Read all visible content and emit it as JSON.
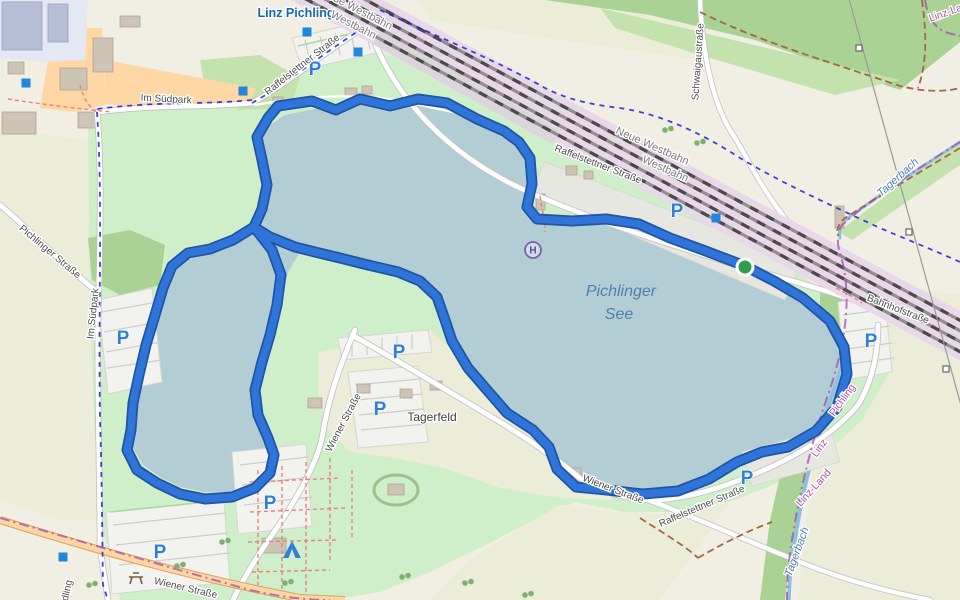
{
  "colors": {
    "land": "#f1efe3",
    "field": "#ecedd8",
    "park": "#cfeeca",
    "wood": "#a9d294",
    "wood_light": "#c3e2ae",
    "water": "#b3cdd5",
    "stream": "#8fc0e0",
    "railway_band": "#e9d8e9",
    "track": "#4a4a4a",
    "track_base": "#8f8f8f",
    "road": "#ffffff",
    "road_casing": "#c2c2c2",
    "primary": "#fcd6a4",
    "primary_casing": "#d9a659",
    "route": "#2f74d9",
    "route_casing": "#1f55a3",
    "cycle": "#2121d6",
    "boundary": "#a04fae",
    "path_red": "#e88378",
    "track_brown": "#a5673f",
    "parking": "#2f7fd6",
    "node": "#2386dd",
    "start": "#2e9e4c",
    "building": "#cdc4b6",
    "building_line": "#b2a391",
    "paved": "#e7e7e1",
    "industrial": "#b7bfd6",
    "retail": "#fed7a5",
    "label_street": "#4d4d4d",
    "label_railway": "#7d7d7d",
    "label_station": "#1467b5",
    "label_place": "#41413b",
    "label_water": "#4d7fae",
    "label_boundary": "#b14fb1"
  },
  "map": {
    "lake_name": "Pichlinger See",
    "station_name": "Linz Pichling",
    "labels": [
      {
        "t": "Linz Pichling",
        "x": 296,
        "y": 17,
        "r": 0,
        "c": "station"
      },
      {
        "t": "Neue Westbahn",
        "x": 355,
        "y": 12,
        "r": 27,
        "c": "railway"
      },
      {
        "t": "Westbahn",
        "x": 352,
        "y": 28,
        "r": 27,
        "c": "railway"
      },
      {
        "t": "Neue Westbahn",
        "x": 651,
        "y": 149,
        "r": 24,
        "c": "railway"
      },
      {
        "t": "Westbahn",
        "x": 664,
        "y": 172,
        "r": 24,
        "c": "railway"
      },
      {
        "t": "Raffelstettner Straße",
        "x": 304,
        "y": 67,
        "r": -38,
        "c": "street"
      },
      {
        "t": "Raffelstettner Straße",
        "x": 597,
        "y": 167,
        "r": 21,
        "c": "street"
      },
      {
        "t": "Raffelstettner Straße",
        "x": 703,
        "y": 509,
        "r": -23,
        "c": "street"
      },
      {
        "t": "Im Südpark",
        "x": 166,
        "y": 102,
        "r": 3,
        "c": "street"
      },
      {
        "t": "Im Südpark",
        "x": 96,
        "y": 314,
        "r": -84,
        "c": "street"
      },
      {
        "t": "Pichlinger Straße",
        "x": 48,
        "y": 254,
        "r": 40,
        "c": "street"
      },
      {
        "t": "Wiener Straße",
        "x": 346,
        "y": 424,
        "r": -62,
        "c": "street"
      },
      {
        "t": "Wiener Straße",
        "x": 612,
        "y": 492,
        "r": 21,
        "c": "street"
      },
      {
        "t": "Wiener Straße",
        "x": 185,
        "y": 591,
        "r": 13,
        "c": "street"
      },
      {
        "t": "Bahnhofstraße",
        "x": 897,
        "y": 312,
        "r": 21,
        "c": "street"
      },
      {
        "t": "Schwaigaustraße",
        "x": 701,
        "y": 62,
        "r": -86,
        "c": "street"
      },
      {
        "t": "dling",
        "x": 70,
        "y": 591,
        "r": -78,
        "c": "street"
      },
      {
        "t": "Tagerfeld",
        "x": 432,
        "y": 421,
        "r": 0,
        "c": "place"
      },
      {
        "t": "Pichlinger",
        "x": 621,
        "y": 296,
        "r": 0,
        "c": "water-lg"
      },
      {
        "t": "See",
        "x": 619,
        "y": 319,
        "r": 0,
        "c": "water-lg"
      },
      {
        "t": "Tagerbach",
        "x": 900,
        "y": 180,
        "r": -42,
        "c": "water-lbl"
      },
      {
        "t": "Tagerbach",
        "x": 800,
        "y": 553,
        "r": -70,
        "c": "water-lbl"
      },
      {
        "t": "Linz-Land",
        "x": 952,
        "y": 14,
        "r": -20,
        "c": "boundary-lbl"
      },
      {
        "t": "Pichling",
        "x": 845,
        "y": 402,
        "r": -54,
        "c": "boundary-lbl"
      },
      {
        "t": "Linz",
        "x": 822,
        "y": 450,
        "r": -54,
        "c": "boundary-lbl"
      },
      {
        "t": "Linz-Land",
        "x": 816,
        "y": 490,
        "r": -48,
        "c": "boundary-lbl"
      }
    ],
    "parking_glyph": "P",
    "parking_icons": [
      [
        315,
        68
      ],
      [
        123,
        337
      ],
      [
        399,
        351
      ],
      [
        380,
        408
      ],
      [
        270,
        502
      ],
      [
        160,
        551
      ],
      [
        677,
        210
      ],
      [
        747,
        477
      ],
      [
        871,
        340
      ]
    ],
    "node_markers": [
      [
        26,
        83
      ],
      [
        243,
        91
      ],
      [
        307,
        32
      ],
      [
        358,
        52
      ],
      [
        716,
        218
      ],
      [
        63,
        557
      ]
    ],
    "bus_stop": {
      "x": 533,
      "y": 250,
      "glyph": "H"
    },
    "start_marker": {
      "x": 745,
      "y": 267
    },
    "camp_icon": {
      "x": 292,
      "y": 550
    },
    "picnic_icon": {
      "x": 136,
      "y": 577
    },
    "tree_icons": [
      [
        225,
        542
      ],
      [
        288,
        583
      ],
      [
        405,
        577
      ],
      [
        468,
        583
      ],
      [
        528,
        595
      ],
      [
        180,
        566
      ],
      [
        668,
        130
      ],
      [
        700,
        143
      ],
      [
        92,
        585
      ]
    ],
    "pylon_icons": [
      [
        859,
        48
      ],
      [
        909,
        232
      ],
      [
        946,
        369
      ]
    ]
  }
}
